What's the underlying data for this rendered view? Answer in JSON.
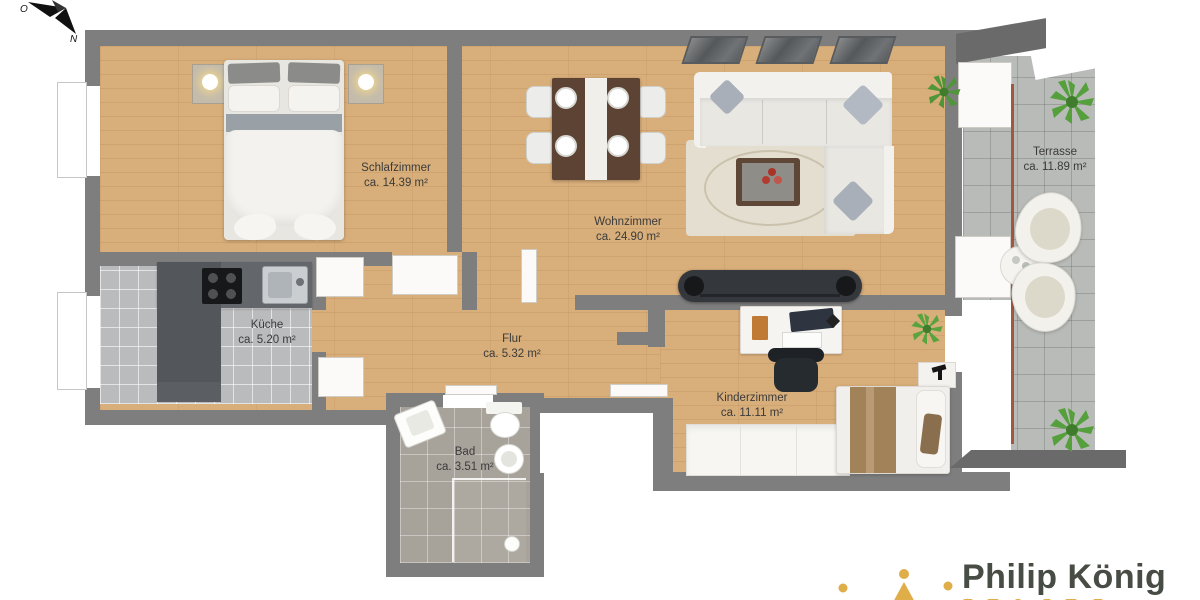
{
  "compass": {
    "o_label": "O",
    "n_label": "N"
  },
  "rooms": [
    {
      "id": "schlafzimmer",
      "name": "Schlafzimmer",
      "area": "ca. 14.39 m²"
    },
    {
      "id": "wohnzimmer",
      "name": "Wohnzimmer",
      "area": "ca. 24.90 m²"
    },
    {
      "id": "kueche",
      "name": "Küche",
      "area": "ca. 5.20 m²"
    },
    {
      "id": "flur",
      "name": "Flur",
      "area": "ca. 5.32 m²"
    },
    {
      "id": "bad",
      "name": "Bad",
      "area": "ca. 3.51 m²"
    },
    {
      "id": "kinderzimmer",
      "name": "Kinderzimmer",
      "area": "ca. 11.11 m²"
    },
    {
      "id": "terrasse",
      "name": "Terrasse",
      "area": "ca. 11.89 m²"
    }
  ],
  "branding": {
    "name": "Philip König"
  },
  "colors": {
    "wall": "#7e7e7e",
    "wall_dark": "#6a6a6a",
    "wood_floor": "#d8ae7a",
    "kitchen_tile": "#b9bbbd",
    "bath_tile": "#a7a29a",
    "terrace_tile": "#b8bbb8",
    "logo_gold": "#dfae49",
    "logo_text": "#474c44",
    "label_text": "#3b3b3b"
  }
}
